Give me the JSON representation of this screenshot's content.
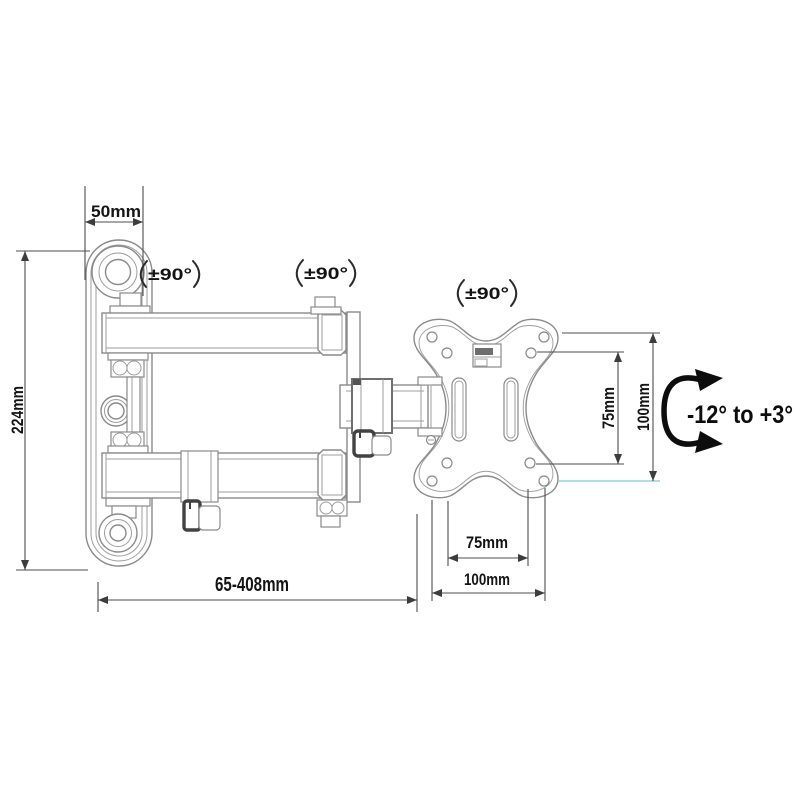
{
  "diagram": {
    "labels": {
      "wall_plate_width": "50mm",
      "wall_plate_height": "224mm",
      "extension_range": "65-408mm",
      "swivel_1": "±90°",
      "swivel_2": "±90°",
      "swivel_3": "±90°",
      "tilt_range": "-12° to +3°",
      "vesa_hole_width": "75mm",
      "vesa_plate_width": "100mm",
      "vesa_hole_height": "75mm",
      "vesa_plate_height": "100mm"
    },
    "colors": {
      "background": "#ffffff",
      "part_outline": "#8a8a8a",
      "dimension_line": "#4d4d4d",
      "label_text": "#141414",
      "dark_hardware": "#424242",
      "accent_extension_line": "#93d4d8"
    }
  }
}
